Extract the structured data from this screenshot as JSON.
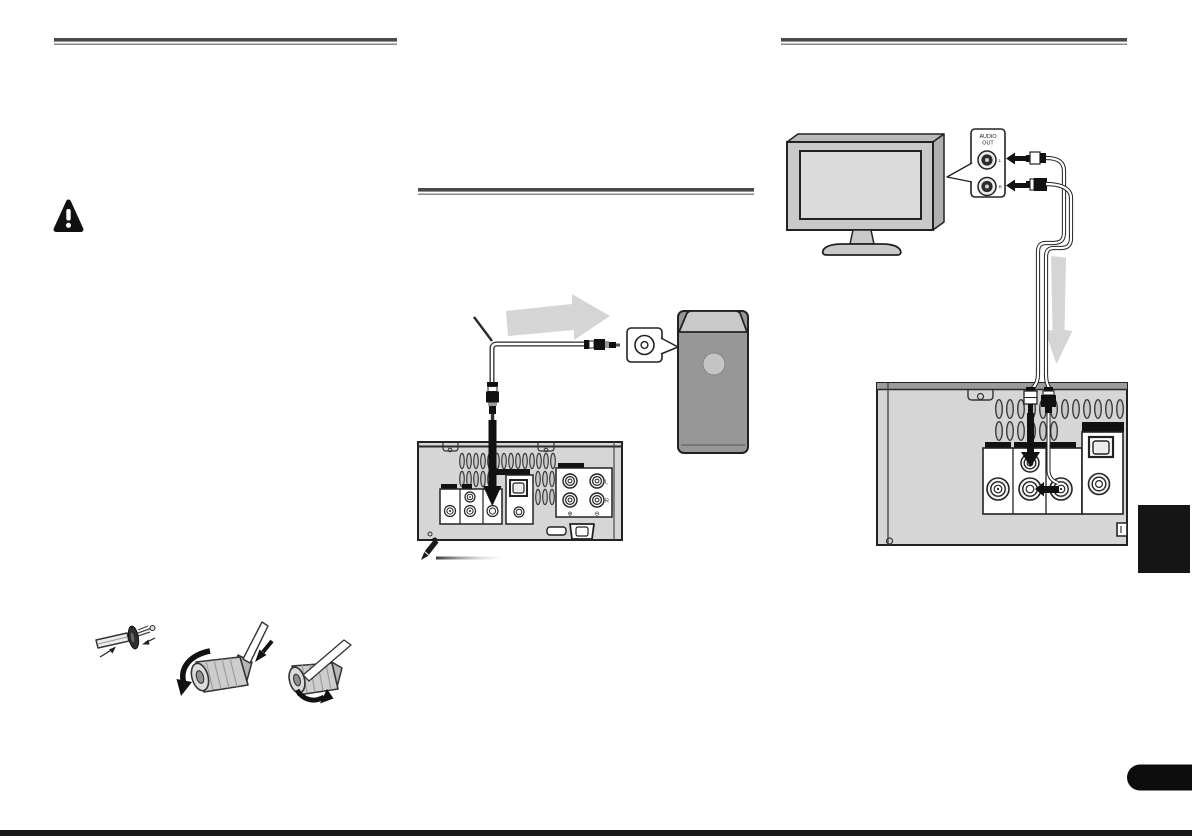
{
  "labels": {
    "tv_callout_line1": "AUDIO",
    "tv_callout_line2": "OUT",
    "tv_jack_left": "L",
    "tv_jack_right": "R",
    "speaker_left": "L",
    "speaker_right": "R",
    "speaker_plus": "⊕",
    "speaker_minus": "⊖"
  },
  "icons": {
    "warning": "warning-triangle",
    "note": "pencil"
  },
  "colors": {
    "panel_gray": "#d6d6d6",
    "flow_arrow_gray": "#d5d5d5",
    "subwoofer_gray": "#979797",
    "subwoofer_top_gray": "#c9c9c9",
    "tv_frame_gray": "#c9c9c9",
    "screen_gray": "#dbdbdb",
    "black_tab": "#151515",
    "rule_gray": "#4a4a4a",
    "page_bottom_edge": "#181818"
  }
}
